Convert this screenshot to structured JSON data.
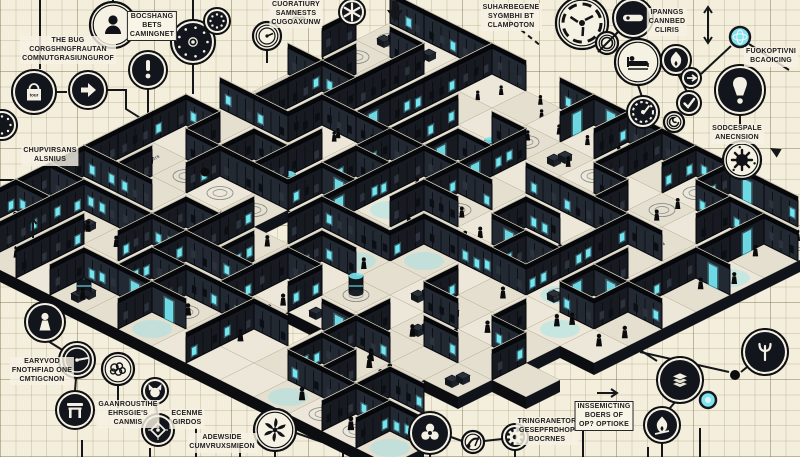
{
  "scene": {
    "description": "Isometric cutaway maze of dark rooms with cyan screens, crowds of small figures, circular annotation icons and garbled caption labels on graph paper",
    "background": "#f4efdc",
    "grid_minor": "#ded4bb",
    "grid_major": "#cdc2a4",
    "accent_cyan": "#74e6f2",
    "ink": "#15161a"
  },
  "labels": [
    {
      "id": "the-bug",
      "text": "THE BUG\nCORGSHNGFRAUTAN\nCOMNUTGRASIUNGUROF"
    },
    {
      "id": "bocshang",
      "text": "BOCSHANG\nBETS\nCAMINGNET"
    },
    {
      "id": "cuoratiury",
      "text": "CUORATIURY\nSAMNESTS\nCUGOAXUNW"
    },
    {
      "id": "suharbegene",
      "text": "SUHARBEGENE\nSYGMBHI BT\nCLAMPOTON"
    },
    {
      "id": "ipanngs",
      "text": "IPANNGS\nCANNBED\nCLIRIS"
    },
    {
      "id": "fuokoptivni",
      "text": "FUOKOPTIVNI\nBCAOICING"
    },
    {
      "id": "sodcespale",
      "text": "SODCESPALE\nANECNSION"
    },
    {
      "id": "chupvirsans",
      "text": "CHUPVIRSANS\nALSNIUS"
    },
    {
      "id": "earyvod",
      "text": "EARYVOD\nFNOTHFIAD ONE\nCMTIGCNON"
    },
    {
      "id": "gaanroustihe",
      "text": "GAANROUSTIHE\nEHRSGIE'S\nCANMIS"
    },
    {
      "id": "ecenme",
      "text": "ECENME\nGIRDOS"
    },
    {
      "id": "adewside",
      "text": "ADEWSIDE\nCUMVRUXSMIEON"
    },
    {
      "id": "tringranetor",
      "text": "TRINGRANETOR\nGESEPFRDHOP\nBOCRNES"
    },
    {
      "id": "inssemicting",
      "text": "INSSEMICTING\nBOERS OF\nOP? OPTIOKE"
    }
  ],
  "icons": [
    {
      "name": "dotted-ring",
      "x": 2,
      "y": 125,
      "r": 15,
      "variant": "dark"
    },
    {
      "name": "shopping-bag",
      "x": 34,
      "y": 92,
      "r": 22,
      "variant": "dark",
      "label": "tour"
    },
    {
      "name": "play-arrow",
      "x": 88,
      "y": 90,
      "r": 19,
      "variant": "dark"
    },
    {
      "name": "person",
      "x": 113,
      "y": 25,
      "r": 23,
      "variant": "light"
    },
    {
      "name": "exclamation",
      "x": 148,
      "y": 70,
      "r": 19,
      "variant": "dark"
    },
    {
      "name": "speaker-dial",
      "x": 193,
      "y": 42,
      "r": 22,
      "variant": "dark"
    },
    {
      "name": "dotted-ring",
      "x": 217,
      "y": 21,
      "r": 13,
      "variant": "dark"
    },
    {
      "name": "mini-gauge",
      "x": 267,
      "y": 36,
      "r": 14,
      "variant": "light"
    },
    {
      "name": "bird",
      "x": 299,
      "y": 19,
      "r": 0,
      "variant": "plain"
    },
    {
      "name": "asterisk-gear",
      "x": 352,
      "y": 12,
      "r": 13,
      "variant": "dark"
    },
    {
      "name": "down-arrow",
      "x": 395,
      "y": 12,
      "r": 0,
      "variant": "plain"
    },
    {
      "name": "shutter",
      "x": 582,
      "y": 23,
      "r": 26,
      "variant": "light"
    },
    {
      "name": "slash-lens",
      "x": 607,
      "y": 43,
      "r": 11,
      "variant": "light"
    },
    {
      "name": "remote-bar",
      "x": 633,
      "y": 18,
      "r": 20,
      "variant": "dark"
    },
    {
      "name": "bed",
      "x": 638,
      "y": 62,
      "r": 23,
      "variant": "light"
    },
    {
      "name": "flame",
      "x": 676,
      "y": 60,
      "r": 15,
      "variant": "dark"
    },
    {
      "name": "arrow-circle",
      "x": 691,
      "y": 78,
      "r": 10,
      "variant": "dark"
    },
    {
      "name": "check",
      "x": 689,
      "y": 103,
      "r": 12,
      "variant": "dark"
    },
    {
      "name": "gauge",
      "x": 643,
      "y": 112,
      "r": 16,
      "variant": "dark"
    },
    {
      "name": "spiral",
      "x": 674,
      "y": 122,
      "r": 10,
      "variant": "light"
    },
    {
      "name": "globe",
      "x": 740,
      "y": 37,
      "r": 10,
      "variant": "teal"
    },
    {
      "name": "bulb-exclamation",
      "x": 740,
      "y": 90,
      "r": 25,
      "variant": "dark"
    },
    {
      "name": "virus",
      "x": 742,
      "y": 160,
      "r": 19,
      "variant": "light"
    },
    {
      "name": "cursor",
      "x": 770,
      "y": 148,
      "r": 0,
      "variant": "plain"
    },
    {
      "name": "dot",
      "x": 205,
      "y": 172,
      "r": 4.5,
      "variant": "plain"
    },
    {
      "name": "arrow-up-small",
      "x": 33,
      "y": 228,
      "r": 0,
      "variant": "plain"
    },
    {
      "name": "pawn",
      "x": 45,
      "y": 322,
      "r": 20,
      "variant": "dark"
    },
    {
      "name": "meter-needle",
      "x": 77,
      "y": 360,
      "r": 18,
      "variant": "dark"
    },
    {
      "name": "brain",
      "x": 118,
      "y": 369,
      "r": 16,
      "variant": "light"
    },
    {
      "name": "gate",
      "x": 75,
      "y": 410,
      "r": 19,
      "variant": "dark"
    },
    {
      "name": "cat",
      "x": 155,
      "y": 391,
      "r": 13,
      "variant": "dark"
    },
    {
      "name": "diamond-target",
      "x": 158,
      "y": 430,
      "r": 16,
      "variant": "dark"
    },
    {
      "name": "turbine",
      "x": 275,
      "y": 430,
      "r": 21,
      "variant": "light"
    },
    {
      "name": "trilobe",
      "x": 430,
      "y": 433,
      "r": 21,
      "variant": "dark"
    },
    {
      "name": "hand",
      "x": 473,
      "y": 442,
      "r": 11,
      "variant": "light"
    },
    {
      "name": "gear",
      "x": 515,
      "y": 437,
      "r": 13,
      "variant": "dark"
    },
    {
      "name": "papers",
      "x": 680,
      "y": 380,
      "r": 23,
      "variant": "dark"
    },
    {
      "name": "flame-slash",
      "x": 662,
      "y": 425,
      "r": 18,
      "variant": "dark"
    },
    {
      "name": "psi-fork",
      "x": 765,
      "y": 352,
      "r": 23,
      "variant": "dark"
    },
    {
      "name": "teal-dot",
      "x": 708,
      "y": 400,
      "r": 8,
      "variant": "teal"
    },
    {
      "name": "dot",
      "x": 735,
      "y": 375,
      "r": 5,
      "variant": "plain"
    },
    {
      "name": "arrow-right",
      "x": 608,
      "y": 393,
      "r": 0,
      "variant": "plain"
    },
    {
      "name": "arrow-up-down",
      "x": 708,
      "y": 25,
      "r": 0,
      "variant": "plain"
    }
  ],
  "connectors": [
    {
      "pts": [
        [
          40,
          0
        ],
        [
          40,
          69
        ]
      ]
    },
    {
      "pts": [
        [
          113,
          0
        ],
        [
          113,
          3
        ]
      ]
    },
    {
      "pts": [
        [
          193,
          0
        ],
        [
          193,
          21
        ]
      ]
    },
    {
      "pts": [
        [
          56,
          92
        ],
        [
          67,
          92
        ]
      ]
    },
    {
      "pts": [
        [
          107,
          90
        ],
        [
          126,
          90
        ],
        [
          126,
          109
        ],
        [
          158,
          129
        ]
      ]
    },
    {
      "pts": [
        [
          148,
          89
        ],
        [
          148,
          120
        ]
      ]
    },
    {
      "pts": [
        [
          193,
          64
        ],
        [
          193,
          94
        ]
      ]
    },
    {
      "pts": [
        [
          267,
          50
        ],
        [
          267,
          63
        ]
      ]
    },
    {
      "pts": [
        [
          352,
          25
        ],
        [
          352,
          39
        ]
      ]
    },
    {
      "pts": [
        [
          500,
          13
        ],
        [
          541,
          46
        ]
      ],
      "dash": true
    },
    {
      "pts": [
        [
          638,
          85
        ],
        [
          642,
          97
        ]
      ]
    },
    {
      "pts": [
        [
          678,
          74
        ],
        [
          687,
          92
        ]
      ]
    },
    {
      "pts": [
        [
          600,
          170
        ],
        [
          668,
          129
        ]
      ]
    },
    {
      "pts": [
        [
          701,
          74
        ],
        [
          731,
          46
        ]
      ]
    },
    {
      "pts": [
        [
          749,
          44
        ],
        [
          789,
          70
        ]
      ]
    },
    {
      "pts": [
        [
          740,
          115
        ],
        [
          740,
          126
        ]
      ]
    },
    {
      "pts": [
        [
          704,
          168
        ],
        [
          723,
          161
        ]
      ]
    },
    {
      "pts": [
        [
          612,
          332
        ],
        [
          657,
          361
        ]
      ]
    },
    {
      "pts": [
        [
          640,
          352
        ],
        [
          729,
          372
        ]
      ]
    },
    {
      "pts": [
        [
          741,
          372
        ],
        [
          752,
          363
        ]
      ]
    },
    {
      "pts": [
        [
          82,
          440
        ],
        [
          82,
          457
        ]
      ]
    },
    {
      "pts": [
        [
          150,
          448
        ],
        [
          150,
          457
        ]
      ]
    },
    {
      "pts": [
        [
          196,
          428
        ],
        [
          196,
          457
        ]
      ]
    },
    {
      "pts": [
        [
          240,
          446
        ],
        [
          240,
          457
        ]
      ]
    },
    {
      "pts": [
        [
          275,
          451
        ],
        [
          275,
          457
        ]
      ]
    },
    {
      "pts": [
        [
          343,
          444
        ],
        [
          343,
          457
        ]
      ]
    },
    {
      "pts": [
        [
          430,
          454
        ],
        [
          430,
          457
        ]
      ]
    },
    {
      "pts": [
        [
          515,
          450
        ],
        [
          515,
          457
        ]
      ]
    },
    {
      "pts": [
        [
          583,
          430
        ],
        [
          583,
          457
        ]
      ]
    },
    {
      "pts": [
        [
          648,
          447
        ],
        [
          648,
          457
        ]
      ]
    },
    {
      "pts": [
        [
          700,
          428
        ],
        [
          700,
          457
        ]
      ]
    },
    {
      "pts": [
        [
          0,
          180
        ],
        [
          56,
          180
        ]
      ]
    },
    {
      "pts": [
        [
          100,
          183
        ],
        [
          100,
          283
        ],
        [
          146,
          312
        ]
      ]
    },
    {
      "pts": [
        [
          110,
          163
        ],
        [
          200,
          171
        ]
      ]
    },
    {
      "pts": [
        [
          45,
          302
        ],
        [
          45,
          291
        ],
        [
          90,
          267
        ]
      ]
    },
    {
      "pts": [
        [
          76,
          378
        ],
        [
          75,
          391
        ]
      ]
    },
    {
      "pts": [
        [
          118,
          385
        ],
        [
          118,
          408
        ]
      ]
    },
    {
      "pts": [
        [
          156,
          404
        ],
        [
          157,
          414
        ]
      ]
    },
    {
      "pts": [
        [
          662,
          443
        ],
        [
          662,
          457
        ]
      ]
    },
    {
      "pts": [
        [
          48,
          341
        ],
        [
          64,
          351
        ]
      ]
    },
    {
      "pts": [
        [
          676,
          401
        ],
        [
          670,
          408
        ]
      ]
    },
    {
      "pts": [
        [
          484,
          441
        ],
        [
          502,
          439
        ]
      ]
    },
    {
      "pts": [
        [
          451,
          437
        ],
        [
          462,
          441
        ]
      ]
    },
    {
      "pts": [
        [
          296,
          433
        ],
        [
          322,
          442
        ]
      ]
    }
  ],
  "maze": {
    "seed": 9,
    "tw": 34,
    "th": 17,
    "wall_h": 26,
    "grid": 13,
    "origin": [
      390,
      40
    ],
    "center": [
      390,
      245
    ],
    "radius": [
      435,
      235
    ],
    "floor_texts": [
      "BE RIS",
      "A4",
      "SEC 2"
    ],
    "colors": {
      "wall_face": "#171b21",
      "wall_face2": "#232932",
      "wall_top": "#06080b",
      "wall_stroke": "#05060a",
      "floor": "#ece7d8",
      "floor2": "#e4dfcf",
      "skirt": "#0b0d11",
      "cyan": "#74e6f2",
      "person": "#0a0a0c"
    }
  }
}
